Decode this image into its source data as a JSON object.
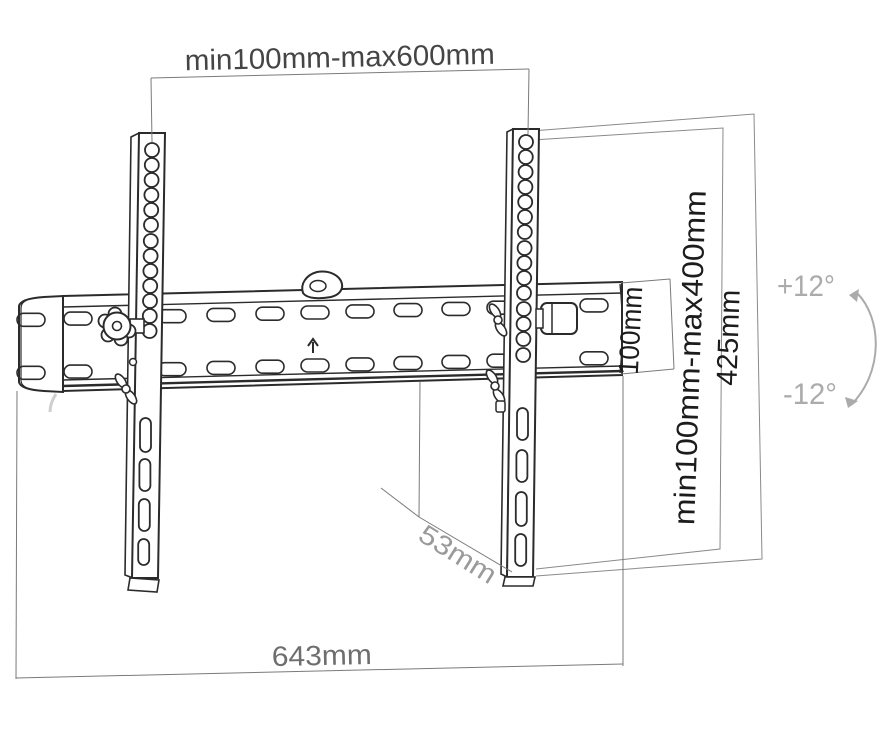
{
  "labels": {
    "rail_width_range": "min100mm-max600mm",
    "vesa_height_range": "min100mm-max400mm",
    "bracket_height": "425mm",
    "rail_height": "100mm",
    "mount_depth": "53mm",
    "total_width": "643mm",
    "tilt_up": "+12°",
    "tilt_down": "-12°"
  },
  "colors": {
    "drawing_line": "#2b2b2b",
    "dimension_line": "#7a7a7a",
    "label_dark": "#1c1c1c",
    "label_medium": "#454545",
    "label_gray": "#6e6e6e",
    "label_soft": "#9a9a9a",
    "label_faint": "#ababab",
    "background": "#ffffff"
  }
}
